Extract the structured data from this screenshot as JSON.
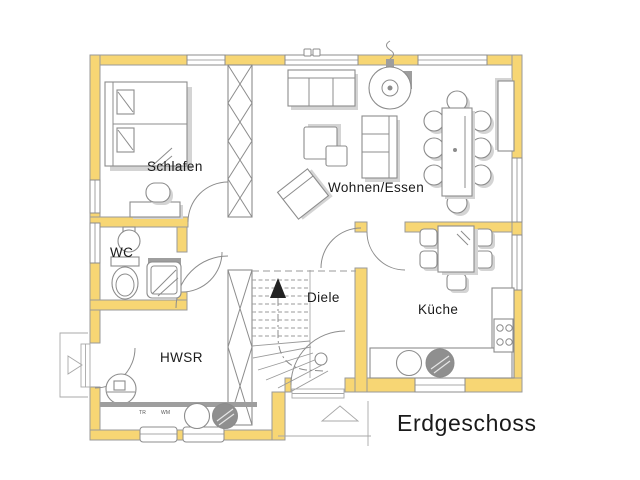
{
  "floor_plan": {
    "title": "Erdgeschoss",
    "rooms": {
      "schlafen": {
        "label": "Schlafen"
      },
      "wohnen_essen": {
        "label": "Wohnen/Essen"
      },
      "wc": {
        "label": "WC"
      },
      "diele": {
        "label": "Diele"
      },
      "kueche": {
        "label": "Küche"
      },
      "hwsr": {
        "label": "HWSR"
      }
    },
    "appliances": {
      "dryer": "TR",
      "washer": "WM"
    }
  },
  "colors": {
    "wall": "#f7d674",
    "wall_outline": "#9a9a9a",
    "line": "#8c8c8c",
    "shadow": "#d4d4d4",
    "dark": "#8f8f8f",
    "text": "#1a1a1a"
  }
}
